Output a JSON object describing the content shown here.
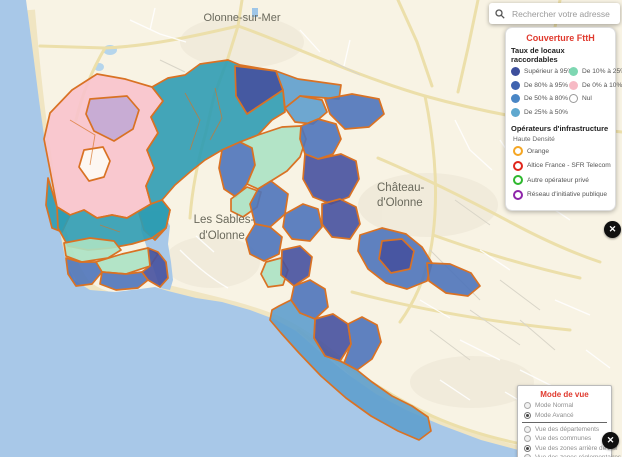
{
  "search": {
    "placeholder": "Rechercher votre adresse"
  },
  "legend": {
    "title": "Couverture FttH",
    "coverage": {
      "title": "Taux de locaux raccordables",
      "left": [
        {
          "label": "Supérieur à 95%",
          "color": "#3d4f9c"
        },
        {
          "label": "De 80% à 95%",
          "color": "#3f63af"
        },
        {
          "label": "De 50% à 80%",
          "color": "#4a86c5"
        },
        {
          "label": "De 25% à 50%",
          "color": "#5fa8cf"
        }
      ],
      "right": [
        {
          "label": "De 10% à 25%",
          "color": "#7ed7b2"
        },
        {
          "label": "De 0% à 10%",
          "color": "#f7bac5"
        },
        {
          "label": "Nul",
          "color": "#ffffff",
          "outline": true
        }
      ]
    },
    "operators": {
      "title": "Opérateurs d'infrastructure",
      "subtitle": "Haute Densité",
      "items": [
        {
          "label": "Orange",
          "ring": "#f5a623"
        },
        {
          "label": "Altice France - SFR Telecom",
          "ring": "#e0251b"
        },
        {
          "label": "Autre opérateur privé",
          "ring": "#2eb82e"
        },
        {
          "label": "Réseau d'initiative publique",
          "ring": "#8e24aa"
        }
      ]
    }
  },
  "view_mode": {
    "title": "Mode de vue",
    "options": [
      {
        "label": "Mode Normal",
        "selected": false
      },
      {
        "label": "Mode Avancé",
        "selected": true,
        "divider_after": true
      },
      {
        "label": "Vue des départements",
        "selected": false
      },
      {
        "label": "Vue des communes",
        "selected": false
      },
      {
        "label": "Vue des zones arrière de PM",
        "selected": true
      },
      {
        "label": "Vue des zones réglementaires",
        "selected": false
      }
    ]
  },
  "map": {
    "labels": {
      "olonne": "Olonne-sur-Mer",
      "chateau_line1": "Château-",
      "chateau_line2": "d'Olonne",
      "sables_line1": "Les Sables-",
      "sables_line2": "d'Olonne"
    }
  },
  "icons": {
    "close": "✕"
  },
  "colors": {
    "accent_red": "#e03a2e",
    "zones": {
      "navy": "#46519e",
      "blue": "#4e74ba",
      "lightblue": "#5e9fcd",
      "teal": "#2f9cb3",
      "mint": "#abe2c3",
      "pink": "#f8c3cc",
      "purple": "#c2a8d4",
      "nul": "#fdfcf5",
      "border": "#d97224"
    }
  }
}
